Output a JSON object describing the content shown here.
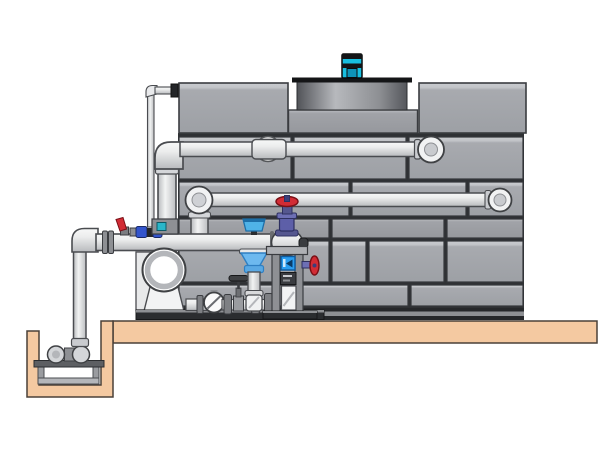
{
  "figure": {
    "title": "cooling-tower-with-pump-skid-and-sump-illustration",
    "has_text": false
  },
  "palette": {
    "bg": "#ffffff",
    "panel": "#a6a8ad",
    "panel-light": "#c9cbcf",
    "panel-dark": "#97999e",
    "seam": "#2f3134",
    "outline": "#4a4c50",
    "pipe": "#e9eaec",
    "pipe-shadow": "#b8babd",
    "base-dark": "#26282b",
    "base-mid": "#8e9094",
    "slab": "#f4c9a1",
    "slab-outline": "#4a4038",
    "motor-cyan": "#18bfe0",
    "motor-dark": "#141517",
    "shroud-dark": "#515358",
    "shroud-light": "#b7b9bd",
    "bell-blue": "#6db9ef",
    "bell-edge": "#2f7fc2",
    "butterfly-blue": "#4fb3e8",
    "display-blue": "#2a9df0",
    "valve-purple": "#5d5fa8",
    "valve-purple-dark": "#2e3060",
    "handwheel-red": "#d22c35",
    "handwheel-red-dark": "#7a1016",
    "dosing-blue": "#3355cc",
    "teal-accent": "#2ab6c9",
    "metal-gray": "#7e8084",
    "pump-ring": "#b4b6ba"
  },
  "components": [
    "fan-motor",
    "fan-shroud",
    "tower-casing-panels",
    "tower-top-right-box",
    "hot-water-inlet-pipe",
    "tower-outlet-pipe",
    "suction-manifold-pipe",
    "manifold-end-cap",
    "discharge-riser-pipe",
    "makeup-thin-pipe",
    "butterfly-valve",
    "globe-valve-red-handwheel",
    "side-red-handwheel-valve",
    "separator-bell-unit",
    "instrument-stand",
    "blue-flow-display",
    "control-module",
    "sight-glass",
    "tee-handle-valve",
    "end-suction-pump",
    "pump-skid-base",
    "concrete-slab",
    "sump-pit",
    "sump-pump",
    "pump-stand"
  ]
}
